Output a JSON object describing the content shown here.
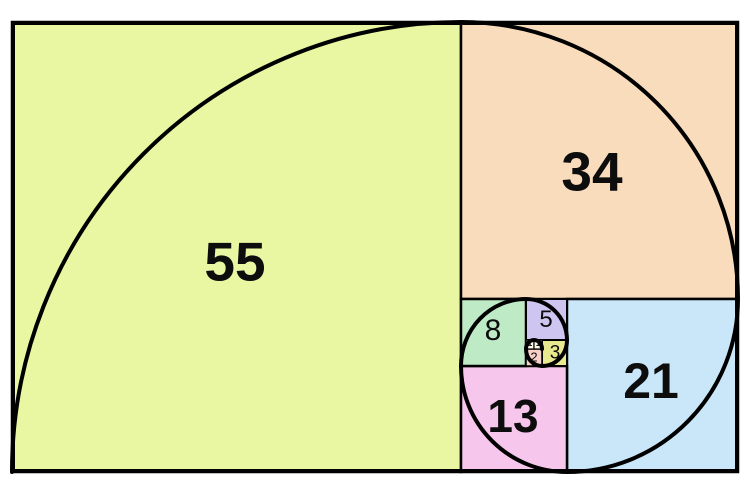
{
  "diagram": {
    "type": "fibonacci-spiral-tiling",
    "background_color": "#ffffff",
    "line_color": "#000000",
    "text_color": "#0d0d0d"
  },
  "squares": [
    {
      "label": "55",
      "color": "#eaf7a2"
    },
    {
      "label": "34",
      "color": "#f8dcbc"
    },
    {
      "label": "21",
      "color": "#c9e7f8"
    },
    {
      "label": "13",
      "color": "#f6c6ec"
    },
    {
      "label": "8",
      "color": "#bfeac6"
    },
    {
      "label": "5",
      "color": "#cfc5f1"
    },
    {
      "label": "3",
      "color": "#e9e98f"
    },
    {
      "label": "2",
      "color": "#f8d1c9"
    },
    {
      "label": "1",
      "color": "#fdf9e9"
    },
    {
      "label": "1",
      "color": "#fdf9e9"
    }
  ]
}
